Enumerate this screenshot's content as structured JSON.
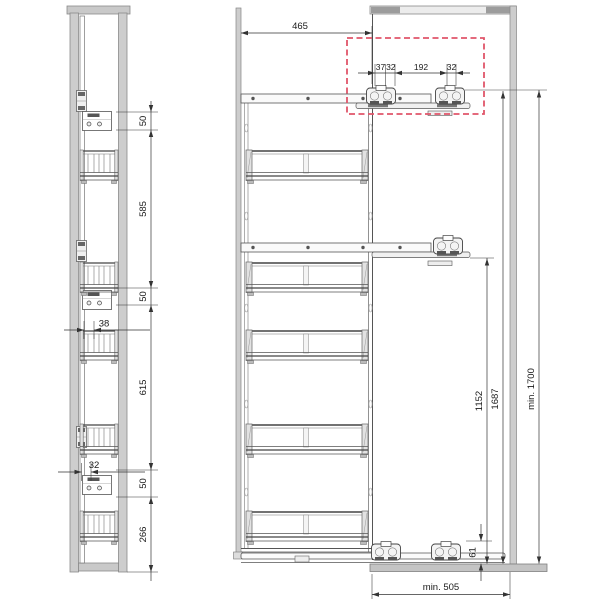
{
  "drawing": {
    "type": "technical-drawing",
    "subject": "tall-cabinet-pullout-larder-unit",
    "views": {
      "front": {
        "name": "front-view",
        "dims": {
          "top_bracket_offset": "50",
          "upper_span": "585",
          "mid_bracket_offset": "50",
          "frame_inset": "38",
          "lower_span": "615",
          "bracket_width": "32",
          "lower_bracket_offset": "50",
          "bottom_span": "266"
        }
      },
      "side": {
        "name": "side-view",
        "dims": {
          "extension": "465",
          "slide_offset": "37",
          "slide_width_front": "32",
          "slide_spacing": "192",
          "slide_width_rear": "32",
          "top_runner_height": "1687",
          "min_height": "min. 1700",
          "mid_runner_height": "1152",
          "floor_clearance": "61",
          "min_depth": "min. 505"
        }
      }
    },
    "colors": {
      "highlight_dashed": "#e0556a",
      "panel_fill": "#cdcdcd",
      "panel_edge": "#8a8a8a",
      "dark_block": "#9c9c9c",
      "line": "#4a4a4a",
      "dim_line": "#333333"
    }
  }
}
